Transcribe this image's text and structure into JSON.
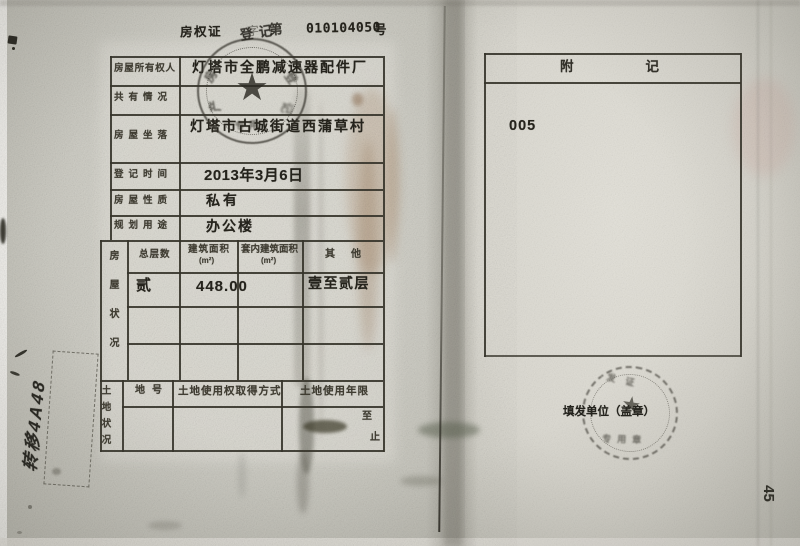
{
  "document": {
    "kind": "房屋所有权证 登记页（扫描件）",
    "title": {
      "prefix": "房权证",
      "middle_faint": "字",
      "middle_bold": "第",
      "number": "010104050",
      "suffix": "号"
    },
    "info_rows": [
      {
        "label": "房屋所有权人",
        "value": "灯塔市全鹏减速器配件厂"
      },
      {
        "label": "共有情况",
        "value": ""
      },
      {
        "label": "房屋坐落",
        "value": "灯塔市古城街道西蒲草村"
      },
      {
        "label": "登记时间",
        "value": "2013年3月6日"
      },
      {
        "label": "房屋性质",
        "value": "私有"
      },
      {
        "label": "规划用途",
        "value": "办公楼"
      }
    ],
    "house_status": {
      "section_label": "房屋状况",
      "columns": [
        "总层数",
        "建筑面积",
        "套内建筑面积",
        "其他"
      ],
      "unit": "(m²)",
      "row": {
        "floors": "贰",
        "area": "448.00",
        "inner_area": "",
        "other": "壹至贰层"
      }
    },
    "land_status": {
      "section_label": "土地状况",
      "columns": [
        "地号",
        "土地使用权取得方式",
        "土地使用年限"
      ],
      "term_from": "至",
      "term_to": "止"
    },
    "remarks": {
      "header": "附记",
      "note": "005"
    },
    "issuer_label": "填发单位（盖章）",
    "page_number": "45",
    "margin_annotation": "转移4A48",
    "left_stamp_top_text": "登记",
    "left_stamp_ring_hint": "房产登记",
    "right_stamp_ring_hint": "发证专用"
  },
  "colors": {
    "paper_left": "#d6d5cd",
    "paper_right": "#e0ded6",
    "ink": "#26241d",
    "grid_line": "#38362c",
    "stamp_ink": "#45443b",
    "stain_sepia": "#9c7046"
  }
}
